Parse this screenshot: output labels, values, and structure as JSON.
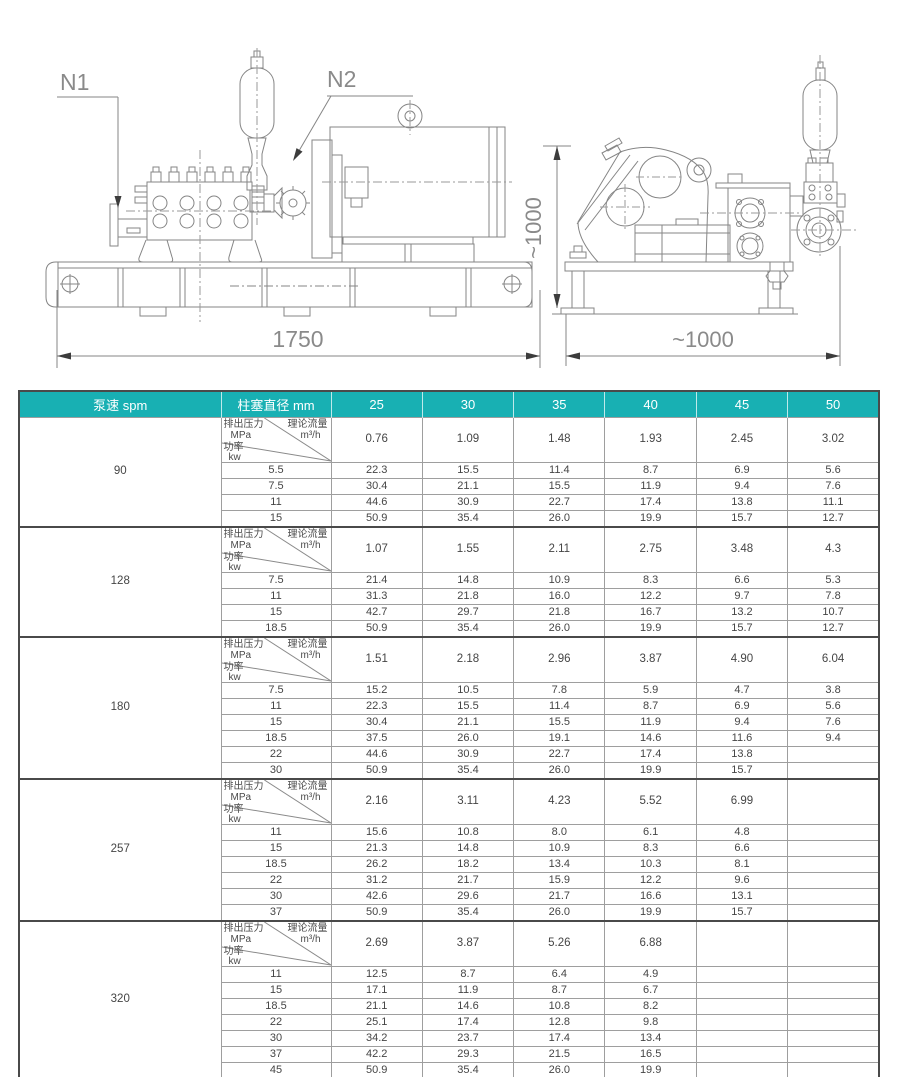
{
  "colors": {
    "accent_teal": "#18b0b3",
    "table_border_dark": "#4a4a4a",
    "table_grid_line": "#9e9e9e",
    "body_text": "#454545",
    "header_text": "#ffffff",
    "drawing_line": "#858585",
    "dimension_text": "#8a8a8a"
  },
  "drawing": {
    "front_view": {
      "label_n1": "N1",
      "label_n2": "N2",
      "dim_length": "1750"
    },
    "side_view": {
      "dim_height": "~1000",
      "dim_width": "~1000"
    }
  },
  "table": {
    "header": {
      "speed": "泵速 spm",
      "diameter": "柱塞直径 mm",
      "diameters": [
        "25",
        "30",
        "35",
        "40",
        "45",
        "50"
      ]
    },
    "corner": {
      "pressure_label": "排出压力",
      "pressure_unit": "MPa",
      "flow_label": "理论流量",
      "flow_unit": "m³/h",
      "power_label": "功率",
      "power_unit": "kw"
    },
    "sections": [
      {
        "speed": "90",
        "flow": [
          "0.76",
          "1.09",
          "1.48",
          "1.93",
          "2.45",
          "3.02"
        ],
        "rows": [
          {
            "pressure": "5.5",
            "power": [
              "22.3",
              "15.5",
              "11.4",
              "8.7",
              "6.9",
              "5.6"
            ]
          },
          {
            "pressure": "7.5",
            "power": [
              "30.4",
              "21.1",
              "15.5",
              "11.9",
              "9.4",
              "7.6"
            ]
          },
          {
            "pressure": "11",
            "power": [
              "44.6",
              "30.9",
              "22.7",
              "17.4",
              "13.8",
              "11.1"
            ]
          },
          {
            "pressure": "15",
            "power": [
              "50.9",
              "35.4",
              "26.0",
              "19.9",
              "15.7",
              "12.7"
            ]
          }
        ]
      },
      {
        "speed": "128",
        "flow": [
          "1.07",
          "1.55",
          "2.11",
          "2.75",
          "3.48",
          "4.3"
        ],
        "rows": [
          {
            "pressure": "7.5",
            "power": [
              "21.4",
              "14.8",
              "10.9",
              "8.3",
              "6.6",
              "5.3"
            ]
          },
          {
            "pressure": "11",
            "power": [
              "31.3",
              "21.8",
              "16.0",
              "12.2",
              "9.7",
              "7.8"
            ]
          },
          {
            "pressure": "15",
            "power": [
              "42.7",
              "29.7",
              "21.8",
              "16.7",
              "13.2",
              "10.7"
            ]
          },
          {
            "pressure": "18.5",
            "power": [
              "50.9",
              "35.4",
              "26.0",
              "19.9",
              "15.7",
              "12.7"
            ]
          }
        ]
      },
      {
        "speed": "180",
        "flow": [
          "1.51",
          "2.18",
          "2.96",
          "3.87",
          "4.90",
          "6.04"
        ],
        "rows": [
          {
            "pressure": "7.5",
            "power": [
              "15.2",
              "10.5",
              "7.8",
              "5.9",
              "4.7",
              "3.8"
            ]
          },
          {
            "pressure": "11",
            "power": [
              "22.3",
              "15.5",
              "11.4",
              "8.7",
              "6.9",
              "5.6"
            ]
          },
          {
            "pressure": "15",
            "power": [
              "30.4",
              "21.1",
              "15.5",
              "11.9",
              "9.4",
              "7.6"
            ]
          },
          {
            "pressure": "18.5",
            "power": [
              "37.5",
              "26.0",
              "19.1",
              "14.6",
              "11.6",
              "9.4"
            ]
          },
          {
            "pressure": "22",
            "power": [
              "44.6",
              "30.9",
              "22.7",
              "17.4",
              "13.8",
              ""
            ]
          },
          {
            "pressure": "30",
            "power": [
              "50.9",
              "35.4",
              "26.0",
              "19.9",
              "15.7",
              ""
            ]
          }
        ]
      },
      {
        "speed": "257",
        "flow": [
          "2.16",
          "3.11",
          "4.23",
          "5.52",
          "6.99",
          ""
        ],
        "rows": [
          {
            "pressure": "11",
            "power": [
              "15.6",
              "10.8",
              "8.0",
              "6.1",
              "4.8",
              ""
            ]
          },
          {
            "pressure": "15",
            "power": [
              "21.3",
              "14.8",
              "10.9",
              "8.3",
              "6.6",
              ""
            ]
          },
          {
            "pressure": "18.5",
            "power": [
              "26.2",
              "18.2",
              "13.4",
              "10.3",
              "8.1",
              ""
            ]
          },
          {
            "pressure": "22",
            "power": [
              "31.2",
              "21.7",
              "15.9",
              "12.2",
              "9.6",
              ""
            ]
          },
          {
            "pressure": "30",
            "power": [
              "42.6",
              "29.6",
              "21.7",
              "16.6",
              "13.1",
              ""
            ]
          },
          {
            "pressure": "37",
            "power": [
              "50.9",
              "35.4",
              "26.0",
              "19.9",
              "15.7",
              ""
            ]
          }
        ]
      },
      {
        "speed": "320",
        "flow": [
          "2.69",
          "3.87",
          "5.26",
          "6.88",
          "",
          ""
        ],
        "rows": [
          {
            "pressure": "11",
            "power": [
              "12.5",
              "8.7",
              "6.4",
              "4.9",
              "",
              ""
            ]
          },
          {
            "pressure": "15",
            "power": [
              "17.1",
              "11.9",
              "8.7",
              "6.7",
              "",
              ""
            ]
          },
          {
            "pressure": "18.5",
            "power": [
              "21.1",
              "14.6",
              "10.8",
              "8.2",
              "",
              ""
            ]
          },
          {
            "pressure": "22",
            "power": [
              "25.1",
              "17.4",
              "12.8",
              "9.8",
              "",
              ""
            ]
          },
          {
            "pressure": "30",
            "power": [
              "34.2",
              "23.7",
              "17.4",
              "13.4",
              "",
              ""
            ]
          },
          {
            "pressure": "37",
            "power": [
              "42.2",
              "29.3",
              "21.5",
              "16.5",
              "",
              ""
            ]
          },
          {
            "pressure": "45",
            "power": [
              "50.9",
              "35.4",
              "26.0",
              "19.9",
              "",
              ""
            ]
          }
        ]
      }
    ]
  }
}
